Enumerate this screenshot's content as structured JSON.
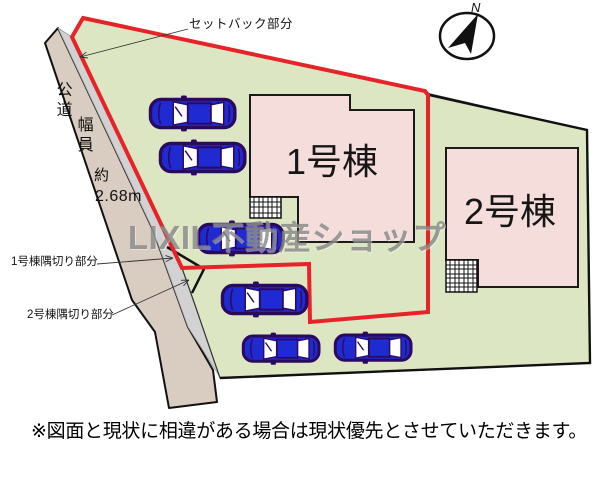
{
  "plan": {
    "compass_label": "N",
    "annotations": {
      "setback": "セットバック部分",
      "corner_cut_1": "1号棟隅切り部分",
      "corner_cut_2": "2号棟隅切り部分"
    },
    "road": {
      "name": "公道",
      "width_label": "幅員",
      "approx_label": "約",
      "width_value": "2.68m"
    },
    "buildings": {
      "b1_label": "1号棟",
      "b2_label": "2号棟"
    },
    "cars_count": 6
  },
  "watermark": "LIXIL不動産ショップ",
  "disclaimer": "※図面と現状に相違がある場合は現状優先とさせていただきます。",
  "colors": {
    "land": "#dde6c3",
    "road": "#d9cdc2",
    "setback_strip": "#d2d2d2",
    "building": "#f4dddb",
    "boundary_red": "#e62328",
    "car_body": "#1f2ad0",
    "car_window": "#ffffff",
    "car_outline": "#2b0a5e",
    "line_black": "#111111"
  }
}
